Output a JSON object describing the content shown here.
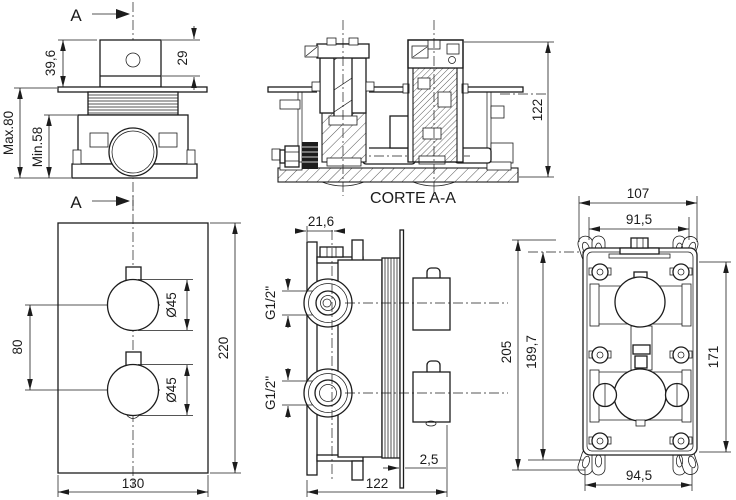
{
  "drawing": {
    "background": "#ffffff",
    "line_color": "#1c1c1c",
    "section_letter": "A",
    "views": {
      "installation": {
        "dims": {
          "handle_height": "39,6",
          "handle_visible": "29",
          "max_depth": "Max.80",
          "min_depth": "Min.58"
        }
      },
      "section": {
        "title": "CORTE A-A",
        "dims": {
          "height": "122"
        }
      },
      "front": {
        "dims": {
          "knob_spacing": "80",
          "knob_dia_top": "Ø45",
          "knob_dia_bottom": "Ø45",
          "plate_height": "220",
          "plate_width": "130"
        }
      },
      "side": {
        "dims": {
          "bracket_offset": "21,6",
          "inlet_top": "G1/2\"",
          "inlet_bottom": "G1/2\"",
          "plate_thickness": "2,5",
          "total_depth": "122"
        }
      },
      "back": {
        "dims": {
          "box_width": "107",
          "ear_span_width": "91,5",
          "total_height": "205",
          "ear_span_height": "189,7",
          "box_height": "171",
          "ear_bottom_width": "94,5"
        }
      }
    }
  }
}
